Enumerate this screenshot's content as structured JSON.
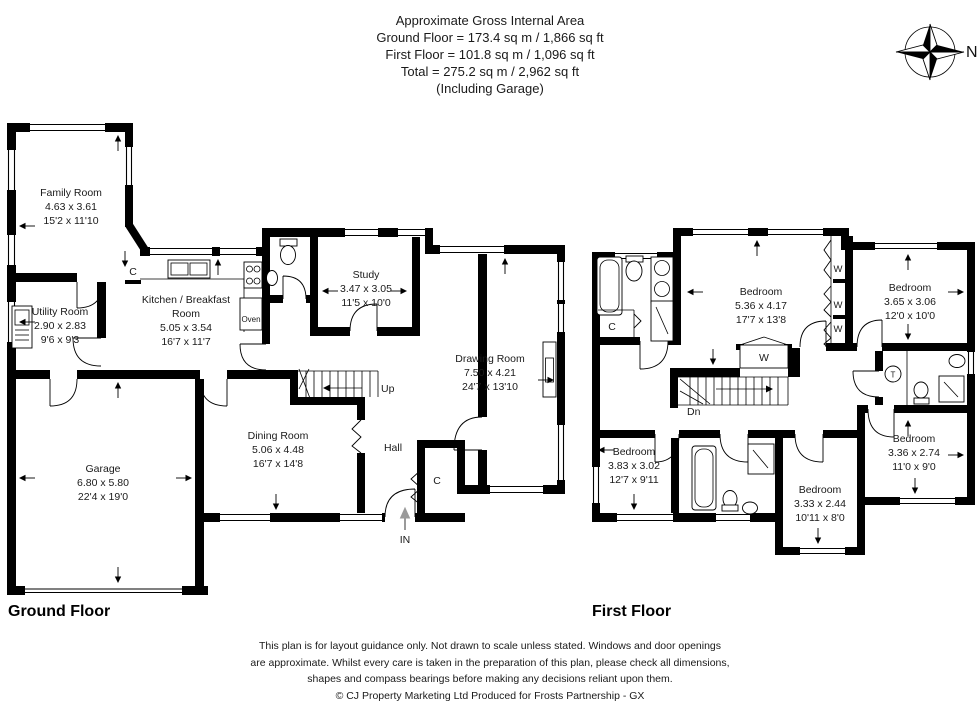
{
  "header": {
    "title": "Approximate Gross Internal Area",
    "ground_area": "Ground Floor = 173.4 sq m / 1,866 sq ft",
    "first_area": "First Floor = 101.8 sq m / 1,096 sq ft",
    "total_area": "Total = 275.2 sq m / 2,962 sq ft",
    "note": "(Including Garage)"
  },
  "compass": {
    "north_label": "N"
  },
  "floors": {
    "ground": {
      "title": "Ground Floor",
      "rooms": [
        {
          "name": "Family Room",
          "metric": "4.63 x 3.61",
          "imperial": "15'2 x 11'10"
        },
        {
          "name": "Utility Room",
          "metric": "2.90 x 2.83",
          "imperial": "9'6 x 9'3"
        },
        {
          "name_line1": "Kitchen / Breakfast",
          "name_line2": "Room",
          "metric": "5.05 x 3.54",
          "imperial": "16'7 x 11'7"
        },
        {
          "name": "Study",
          "metric": "3.47 x 3.05",
          "imperial": "11'5 x 10'0"
        },
        {
          "name": "Drawing Room",
          "metric": "7.50 x 4.21",
          "imperial": "24'7 x 13'10"
        },
        {
          "name": "Dining Room",
          "metric": "5.06 x 4.48",
          "imperial": "16'7 x 14'8"
        },
        {
          "name": "Garage",
          "metric": "6.80 x 5.80",
          "imperial": "22'4 x 19'0"
        },
        {
          "name": "Hall"
        }
      ]
    },
    "first": {
      "title": "First Floor",
      "rooms": [
        {
          "name": "Bedroom",
          "metric": "5.36 x 4.17",
          "imperial": "17'7 x 13'8"
        },
        {
          "name": "Bedroom",
          "metric": "3.65 x 3.06",
          "imperial": "12'0 x 10'0"
        },
        {
          "name": "Bedroom",
          "metric": "3.83 x 3.02",
          "imperial": "12'7 x 9'11"
        },
        {
          "name": "Bedroom",
          "metric": "3.33 x 2.44",
          "imperial": "10'11 x 8'0"
        },
        {
          "name": "Bedroom",
          "metric": "3.36 x 2.74",
          "imperial": "11'0 x 9'0"
        }
      ]
    }
  },
  "labels": {
    "up": "Up",
    "down": "Dn",
    "entrance": "IN",
    "hall": "Hall",
    "oven": "Oven",
    "cupboard": "C",
    "wardrobe": "W",
    "tank": "T"
  },
  "footer": {
    "line1": "This plan is for layout guidance only. Not drawn to scale unless stated. Windows and door openings",
    "line2": "are approximate. Whilst every care is taken in the preparation of this plan, please check all dimensions,",
    "line3": "shapes and compass bearings before making any decisions reliant upon them.",
    "line4": "© CJ Property Marketing Ltd Produced for Frosts Partnership - GX"
  }
}
